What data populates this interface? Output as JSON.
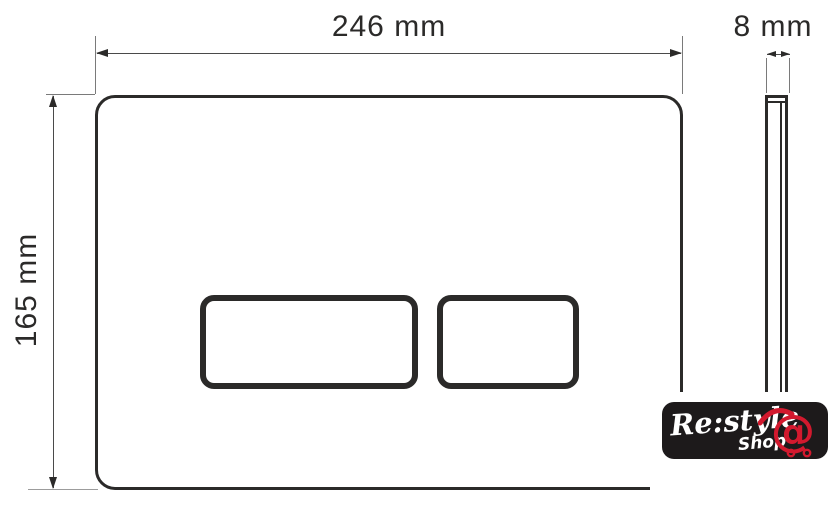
{
  "diagram": {
    "type": "technical-drawing",
    "subject": "flush-plate front and side view with dimensions",
    "front_view": {
      "width_label": "246 mm",
      "height_label": "165 mm",
      "buttons": 2
    },
    "side_view": {
      "thickness_label": "8 mm"
    }
  },
  "logo": {
    "brand": "Re:style",
    "subtitle": "Shop",
    "icon": "shopping-cart-at-sign"
  },
  "colors": {
    "outline": "#2b2a29",
    "dimension_line": "#4a4a4a",
    "extension_line": "#9c9c9c",
    "logo_background": "#1d1a1b",
    "logo_accent_red": "#d2192e",
    "background": "#ffffff"
  }
}
